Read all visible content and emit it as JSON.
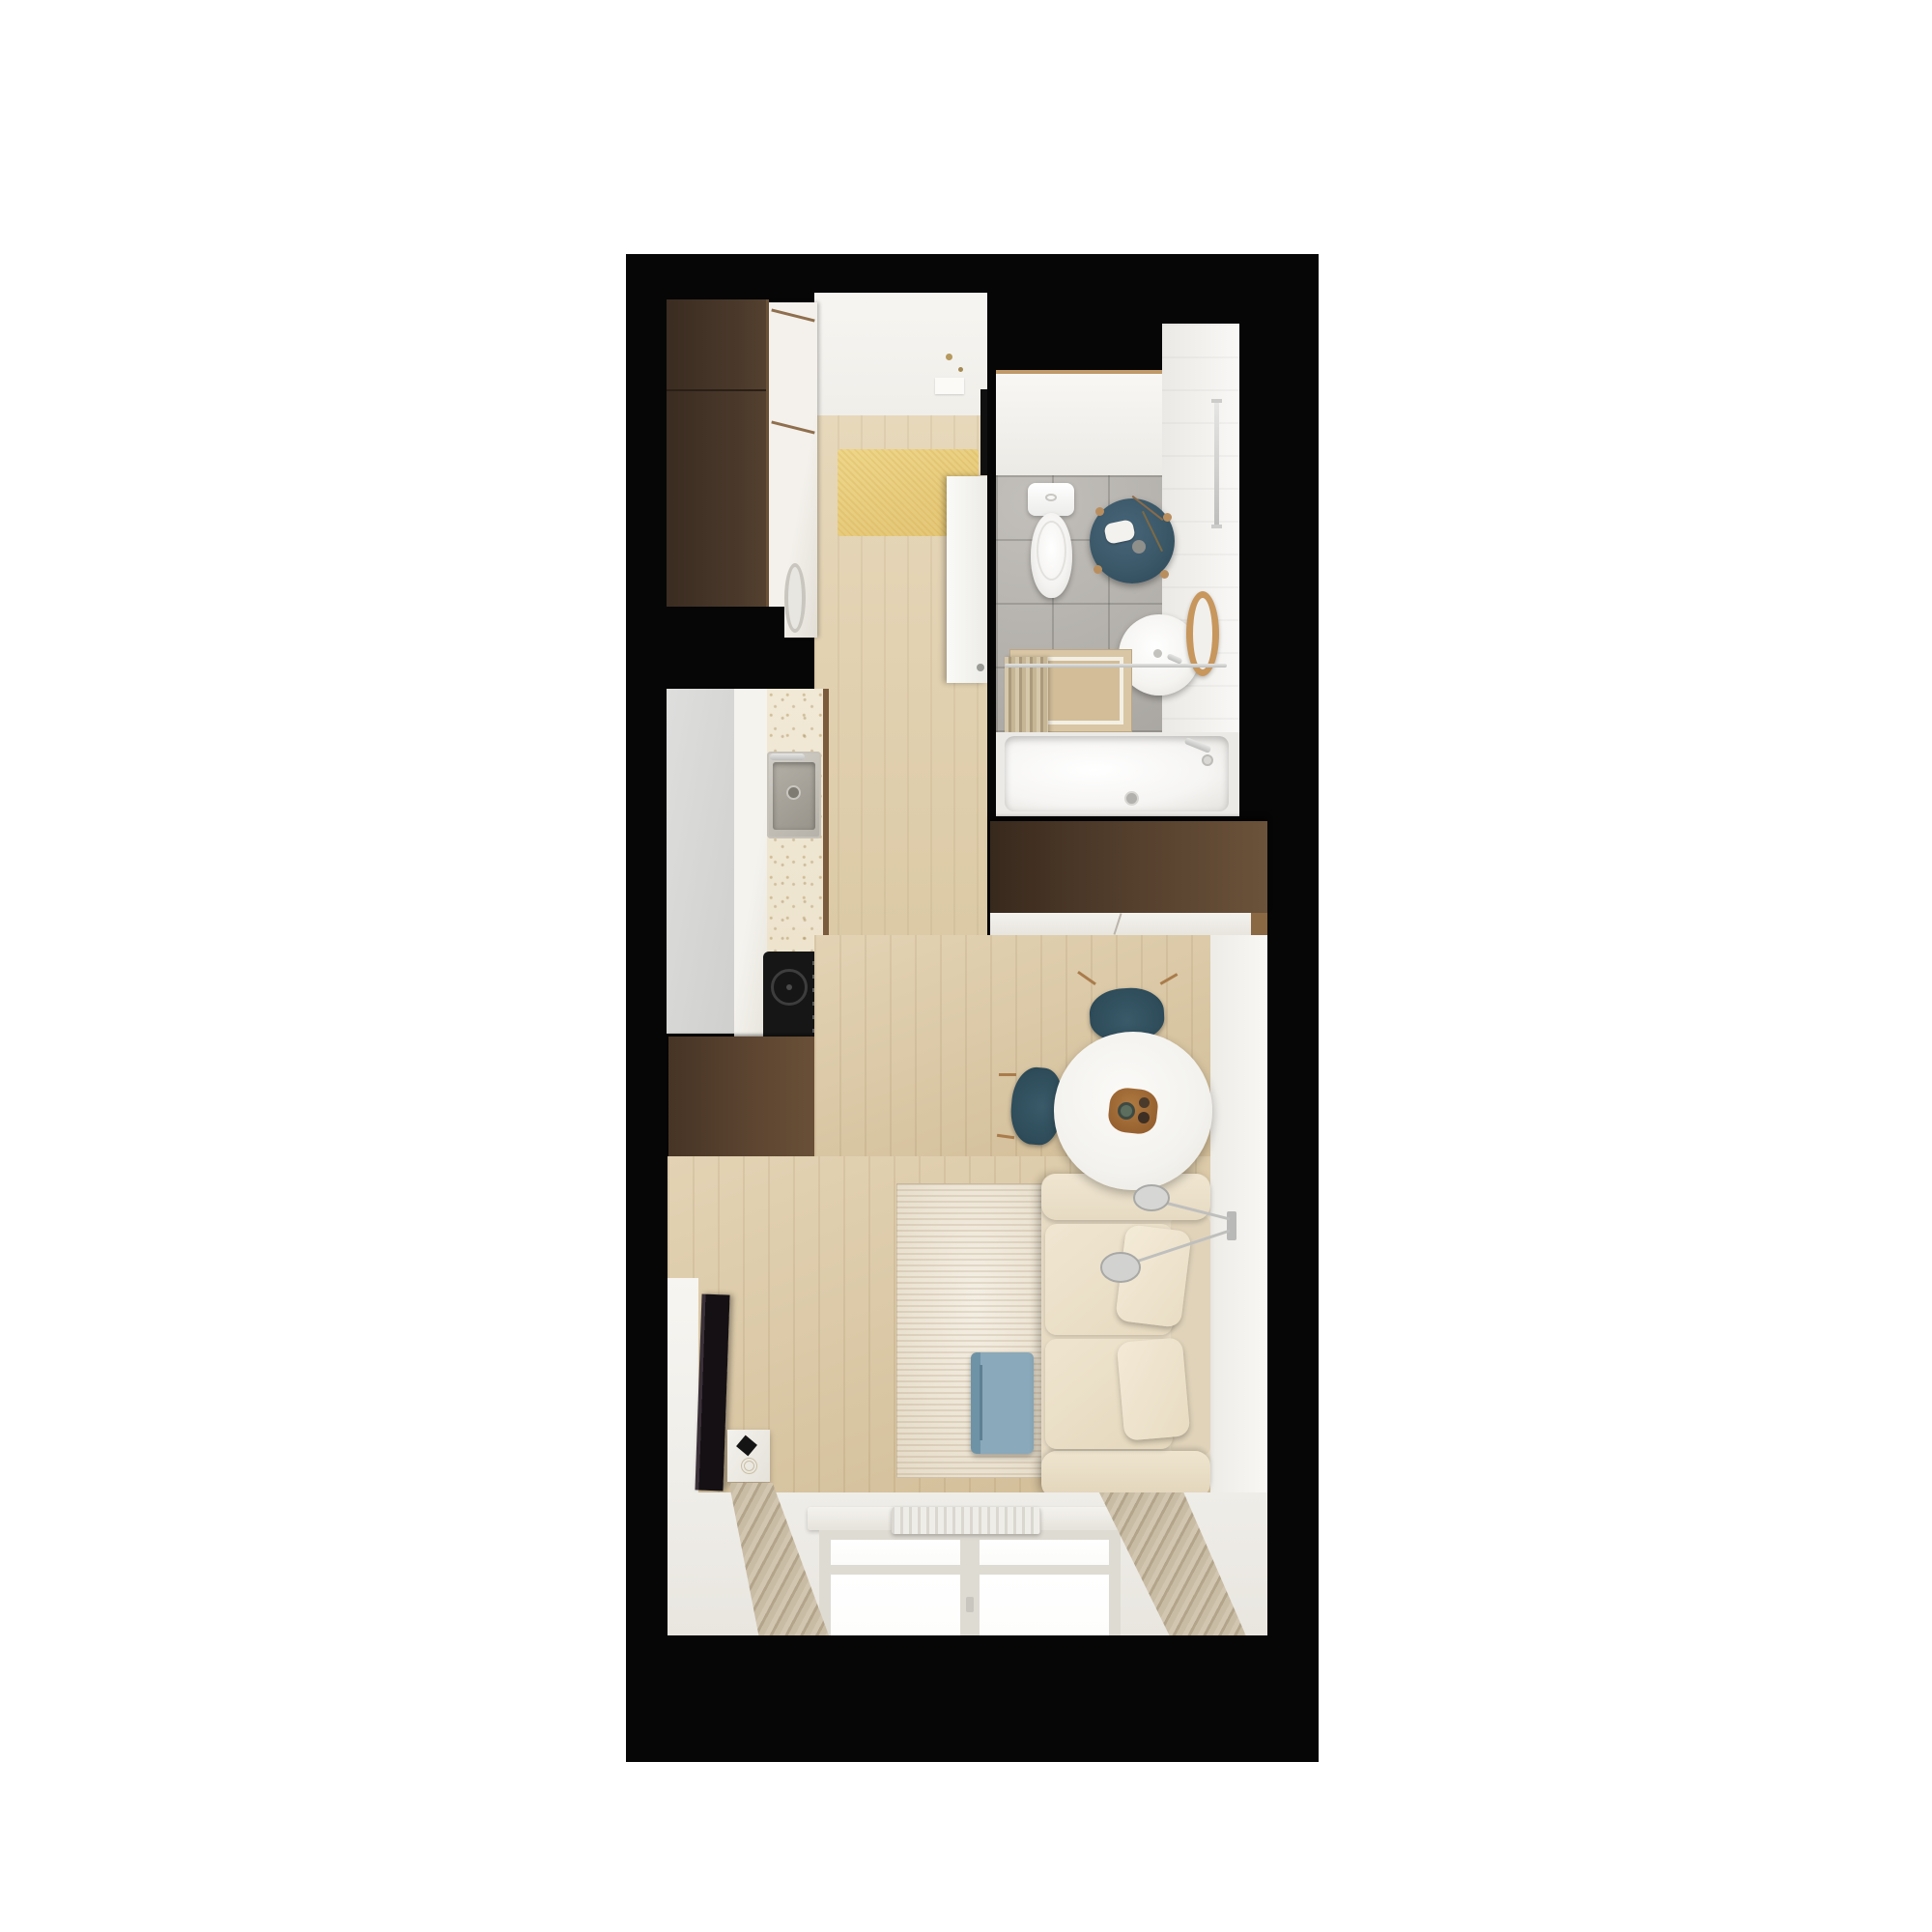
{
  "title": "Studio apartment floor plan — top-down 3D render",
  "palette": {
    "background": "#ffffff",
    "walls": "#060606",
    "wood_floor": "#dbc9a7",
    "entry_mat": "#e9cf82",
    "dark_wardrobe": "#443327",
    "kitchen_cabinet": "#5a4533",
    "shelf_unit": "#6d5440",
    "counter_top": "#efe7d3",
    "cooktop": "#181818",
    "bathroom_tile": "#b4b1ac",
    "sanitary_white": "#fbfbfa",
    "stool_teal": "#3a5868",
    "chair_teal": "#31505e",
    "mirror_wood": "#c7975d",
    "sofa_beige": "#eadfc9",
    "rug_cream": "#efe9dc",
    "side_table_blue": "#87a6b7",
    "curtain_beige": "#c9bca5",
    "tray_wood": "#9c6636"
  },
  "plan": {
    "rooms": [
      {
        "name": "entry-hall",
        "furniture": [
          "entrance-door",
          "dark-wardrobe",
          "tall-closet",
          "washing-machine",
          "yellow-doormat",
          "bathroom-door"
        ]
      },
      {
        "name": "bathroom",
        "furniture": [
          "toilet",
          "teal-stool",
          "round-washbasin",
          "wood-mirror",
          "bath-mat",
          "shower-curtain",
          "curtain-rail",
          "bathtub",
          "towel-rail"
        ]
      },
      {
        "name": "kitchen",
        "furniture": [
          "tall-fridge-unit",
          "counter-with-sink",
          "steel-sink",
          "induction-cooktop",
          "brown-base-cabinet",
          "open-shelving"
        ]
      },
      {
        "name": "living-room",
        "furniture": [
          "wall-tv",
          "media-console",
          "cream-rug",
          "blue-side-table",
          "round-dining-table",
          "wooden-tray",
          "dining-chair-north",
          "dining-chair-west",
          "beige-sofa",
          "sofa-pillows",
          "wall-lamp",
          "wardrobe-below-bathroom",
          "window",
          "radiator",
          "curtain-left",
          "curtain-right"
        ]
      }
    ]
  }
}
